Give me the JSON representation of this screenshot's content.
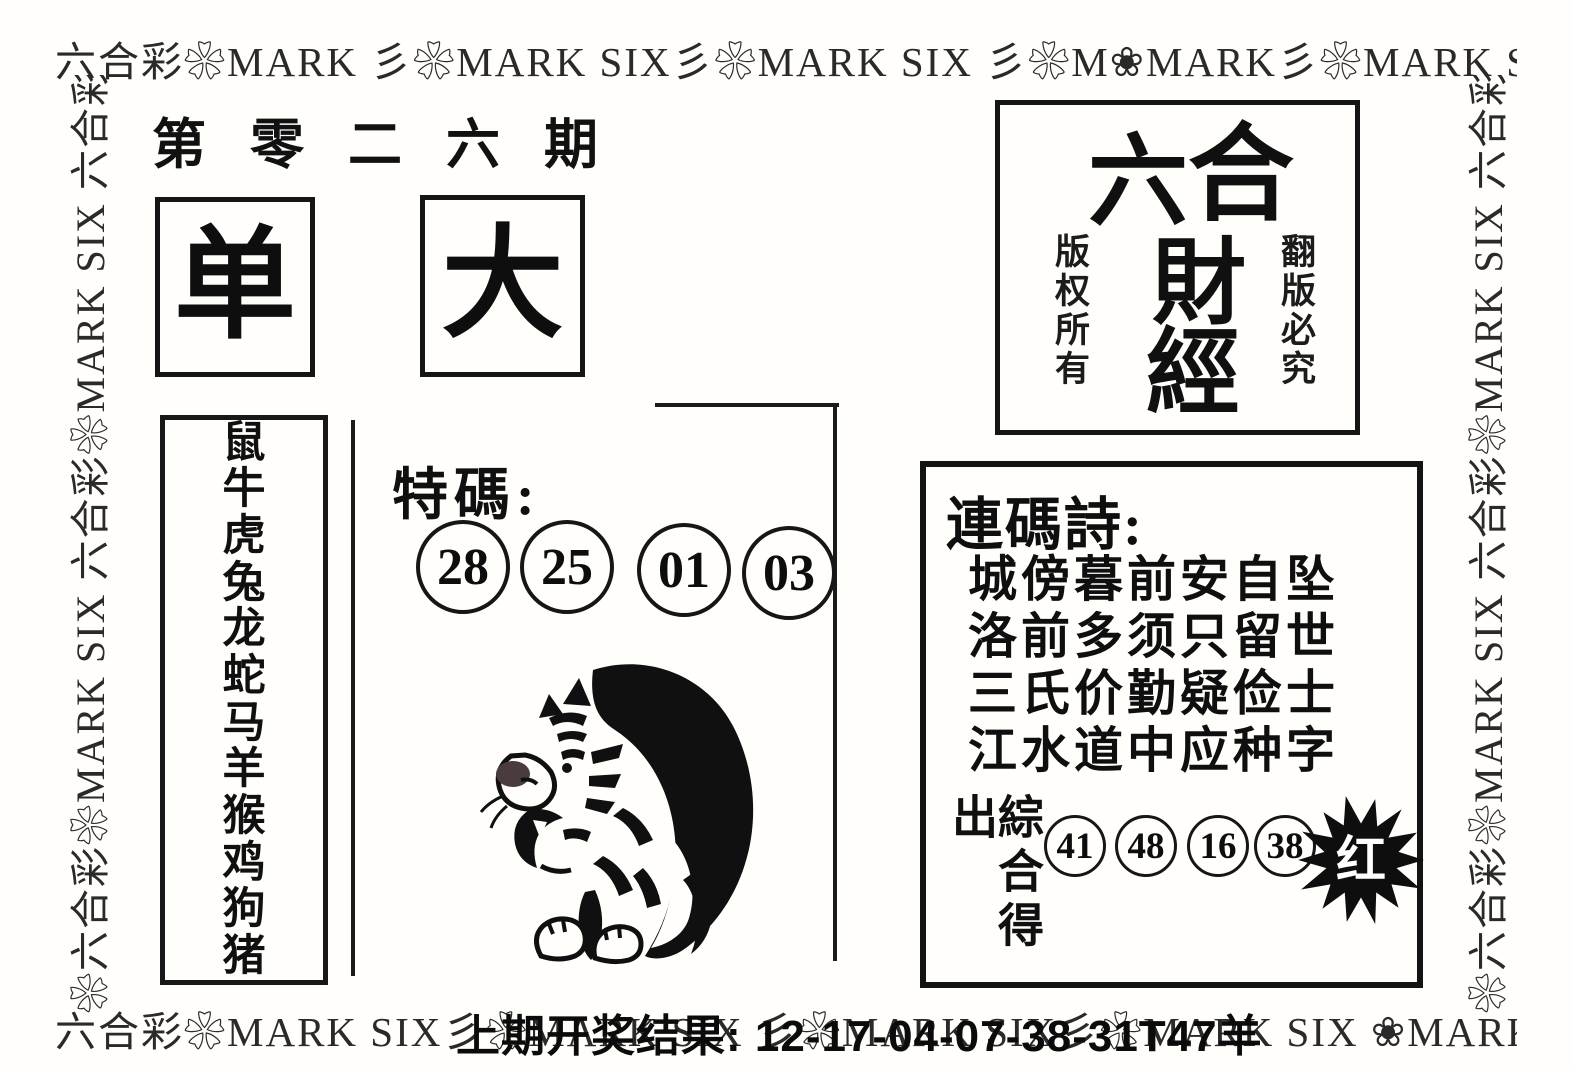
{
  "header": {
    "issue": "第零二六期"
  },
  "borders": {
    "top": "六合彩❀MARK 彡❀MARK SIX彡❀MARK SIX 彡❀M❀MARK彡❀MARK SIX 六合IX",
    "bottom": "六合彩❀MARK SIX彡❀MARK SIX 彡❀MARK SIX彡❀MARK SIX ❀MARK SIX",
    "left": "❀六合彩❀MARK SIX 六合彩❀MARK SIX 六合彩❀❀",
    "right": "❀六合彩❀MARK SIX 六合彩❀MARK SIX 六合彩❀❀"
  },
  "indicators": {
    "odd": "单",
    "big": "大"
  },
  "logo_box": {
    "char_1": "六",
    "char_2": "合",
    "char_3": "財",
    "char_4": "經",
    "left_note": "版权所有",
    "right_note": "翻版必究"
  },
  "zodiac": {
    "animals": [
      "鼠",
      "牛",
      "虎",
      "兔",
      "龙",
      "蛇",
      "马",
      "羊",
      "猴",
      "鸡",
      "狗",
      "猪"
    ]
  },
  "special_code": {
    "label": "特碼:",
    "numbers": [
      "28",
      "25",
      "01",
      "03"
    ]
  },
  "tiger_image": {
    "name": "ink-tiger",
    "ink_color": "#101010",
    "nose_patch_color": "#4a3b3c"
  },
  "poem_panel": {
    "title": "連碼詩:",
    "lines": [
      "城傍暮前安自坠",
      "洛前多须只留世",
      "三氏价勤疑俭士",
      "江水道中应种字"
    ],
    "summary_label": "綜合得出",
    "numbers": [
      "41",
      "48",
      "16",
      "38"
    ],
    "burst_label": "红",
    "burst_color": "#0e0e0e",
    "burst_text_color": "#ffffff"
  },
  "footer": {
    "last_result": "上期开奖结果: 12-17-04-07-38-31T47羊"
  }
}
